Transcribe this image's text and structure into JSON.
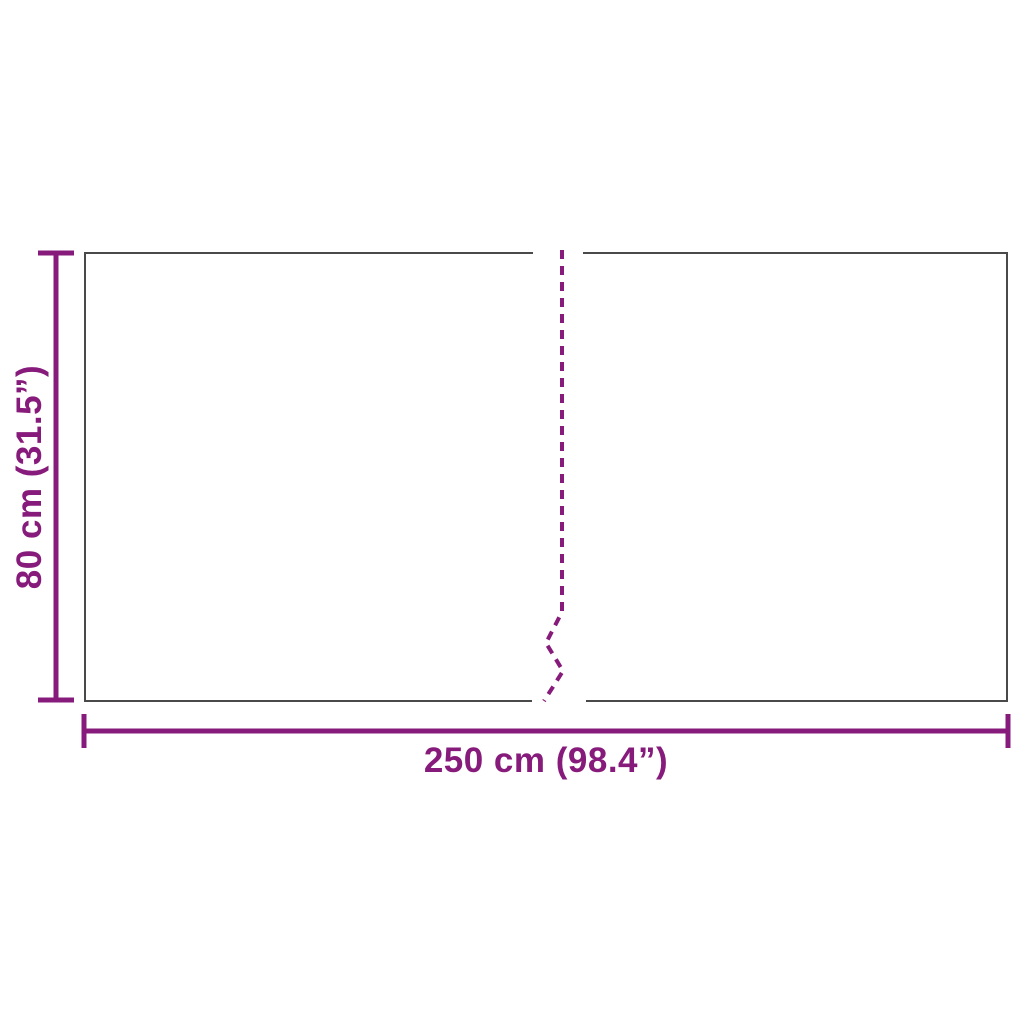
{
  "diagram": {
    "type": "product-dimension-diagram",
    "height_label": "80 cm (31.5”)",
    "width_label": "250 cm (98.4”)",
    "height_value_cm": 80,
    "height_value_inches": 31.5,
    "width_value_cm": 250,
    "width_value_inches": 98.4
  },
  "colors": {
    "accent": "#871B7B",
    "border": "#4A4A4A",
    "background": "#FFFFFF"
  }
}
